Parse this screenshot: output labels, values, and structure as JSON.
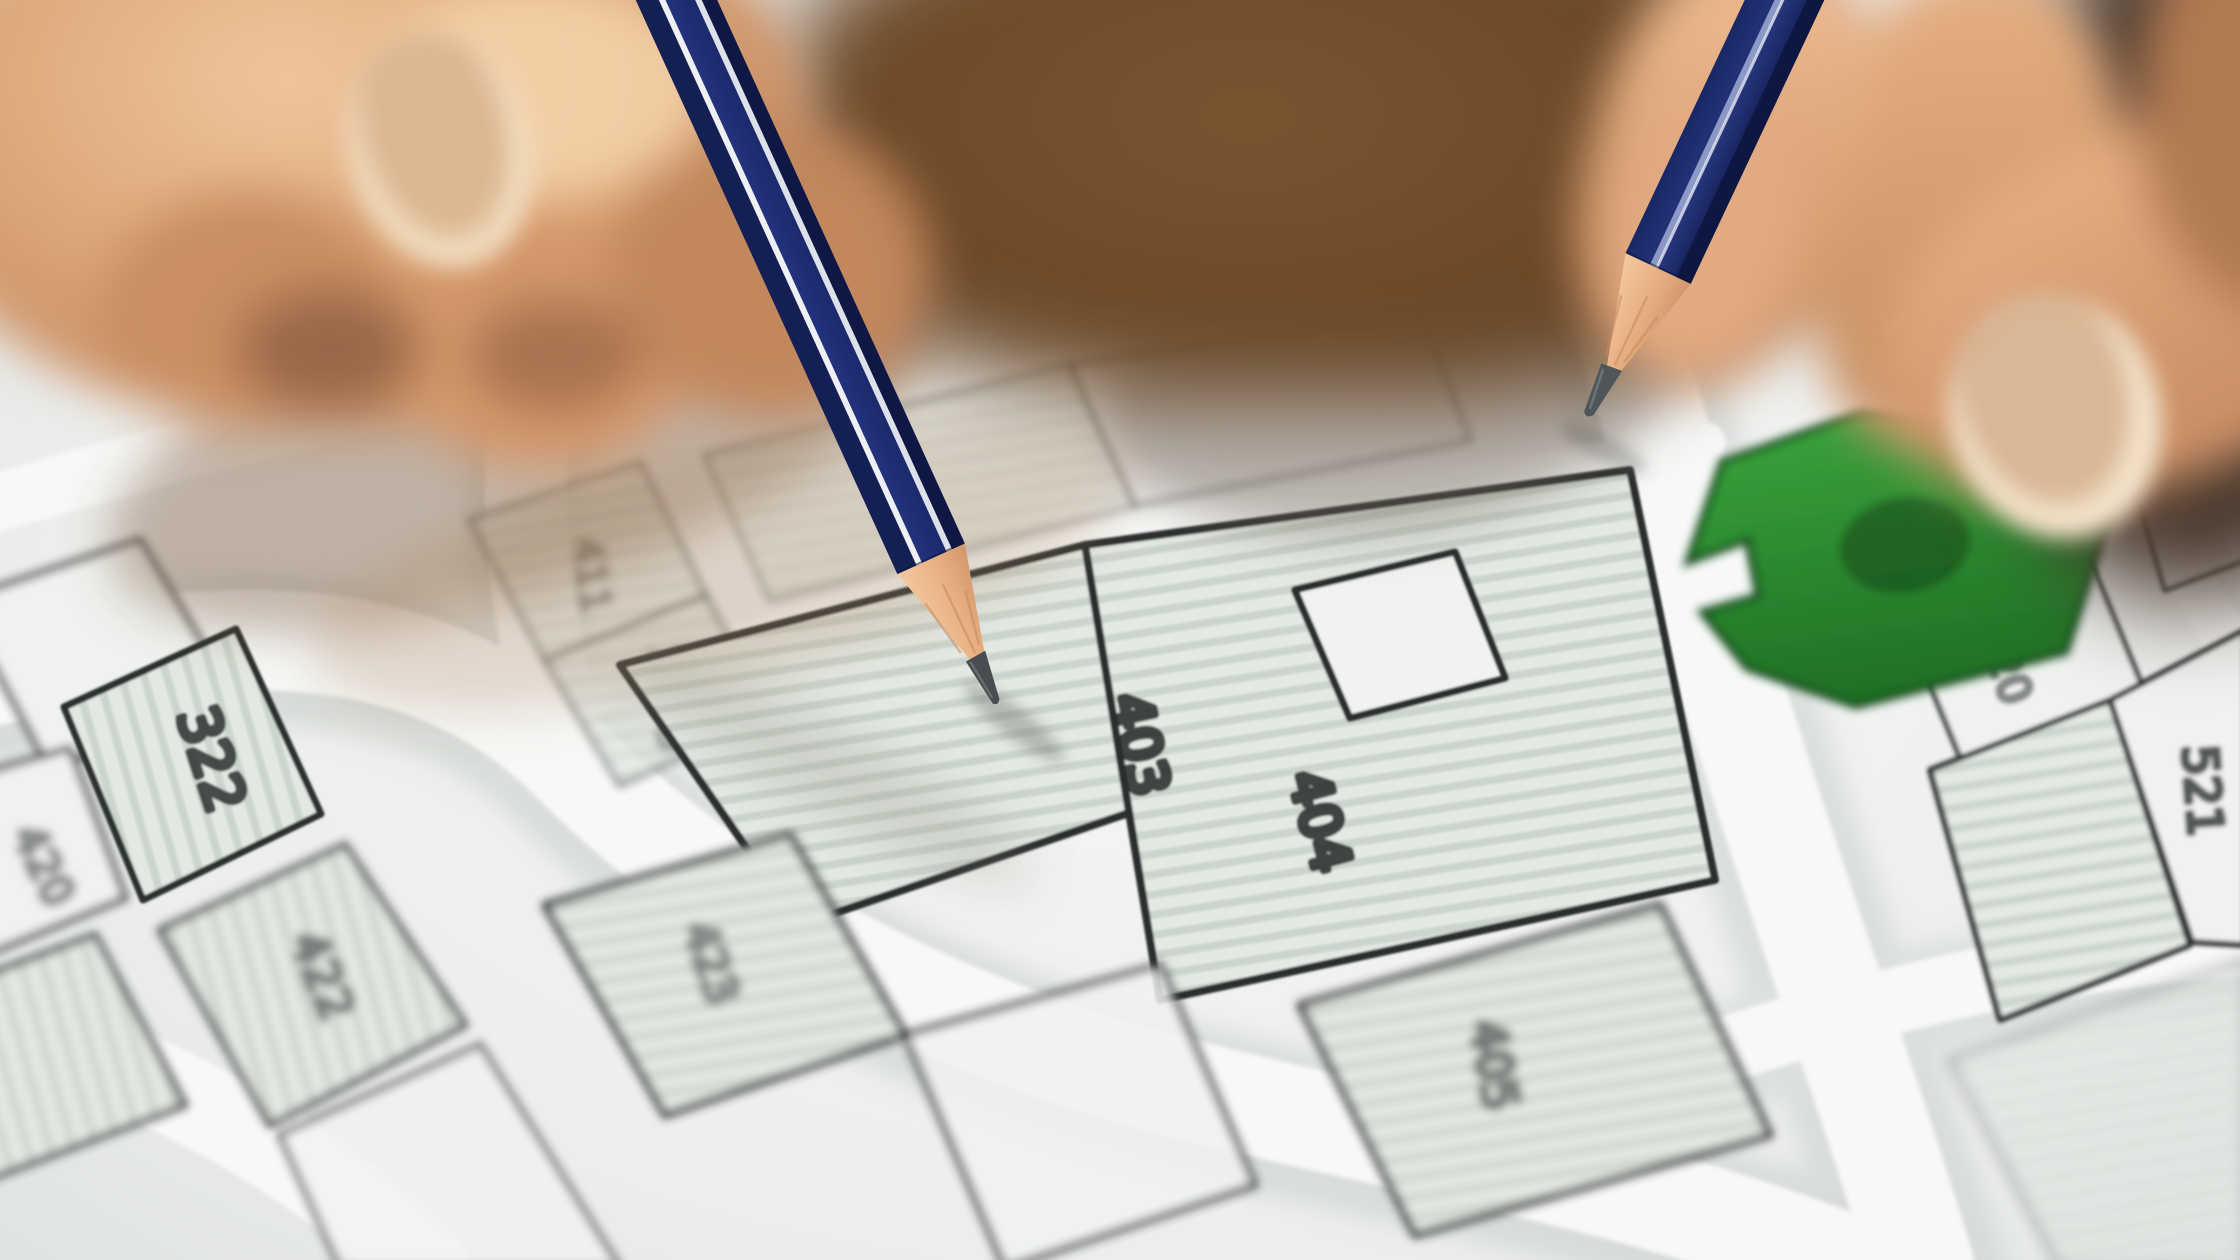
{
  "scene": {
    "description": "Close-up photograph of two hands holding dark blue pencils, both pencil tips pointing at parcels of a cadastral land-registry map; one parcel is highlighted green",
    "subject": "cadastral parcel map with numbered lots"
  },
  "map": {
    "parcels": [
      {
        "label": "322"
      },
      {
        "label": "420"
      },
      {
        "label": "422"
      },
      {
        "label": "423"
      },
      {
        "label": "411"
      },
      {
        "label": "1175"
      },
      {
        "label": "403"
      },
      {
        "label": "404"
      },
      {
        "label": "405"
      },
      {
        "label": "520"
      },
      {
        "label": "521"
      }
    ],
    "green_parcel": {
      "note": "highlighted lot, no visible number"
    }
  },
  "colors": {
    "paper": "#f2f4f2",
    "parcel_fill": "#e4e9e4",
    "parcel_hatch": "#ccd5cd",
    "parcel_outline": "#2f3332",
    "road": "#f7f8f7",
    "green_parcel": "#2f9634",
    "green_outline": "#164c1a",
    "pencil_body": "#1f2d75",
    "pencil_stripe": "#eef0f4",
    "pencil_wood": "#e8b88f",
    "pencil_graphite": "#474d50",
    "skin": "#d89f73",
    "background_brown": "#5d3f26"
  }
}
